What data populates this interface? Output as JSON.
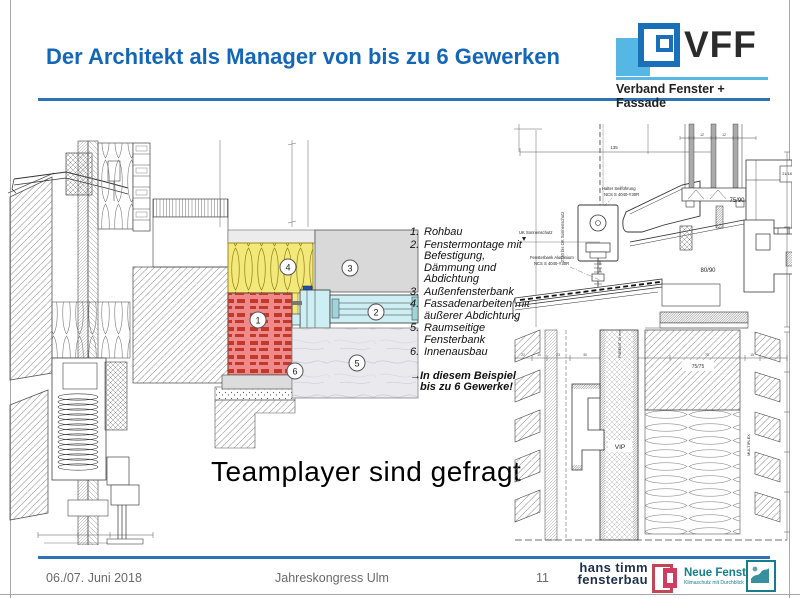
{
  "slide": {
    "title": "Der Architekt als Manager von bis zu 6 Gewerken",
    "tagline": "Teamplayer sind gefragt"
  },
  "colors": {
    "accent_blue": "#2e74b5",
    "title_blue": "#1467b8",
    "vff_lightblue": "#56b7e5",
    "insulation_yellow": "#f3e87a",
    "brick_red": "#f08a8a",
    "frame_cyan": "#cdeef2",
    "hanstimm_red": "#d13d62",
    "neuefenster_teal": "#157d8d"
  },
  "logo_vff": {
    "acronym": "VFF",
    "subtitle": "Verband Fenster + Fassade"
  },
  "gewerke_list": {
    "items": [
      {
        "num": "1.",
        "text": "Rohbau"
      },
      {
        "num": "2.",
        "text": "Fenstermontage mit Befestigung, Dämmung und Abdichtung"
      },
      {
        "num": "3.",
        "text": "Außenfensterbank"
      },
      {
        "num": "4.",
        "text": "Fassadenarbeiten mit äußerer Abdichtung"
      },
      {
        "num": "5.",
        "text": "Raumseitige Fensterbank"
      },
      {
        "num": "6.",
        "text": "Innenausbau"
      }
    ],
    "arrow": "→",
    "conclusion_line1": "In diesem Beispiel",
    "conclusion_line2": "bis zu 6 Gewerke!"
  },
  "left_drawing": {
    "callouts": [
      "1",
      "2",
      "3",
      "4",
      "5",
      "6"
    ]
  },
  "right_drawing": {
    "labels": {
      "halter1": "Halter Seilführung",
      "halter2": "NCS S 4040-Y30R",
      "uk": "UK Sonnenschutz",
      "fb1": "Fensterbank Aluminium",
      "fb2": "NCS S 4040-Y30R",
      "vdim": "2730 bis OK Sonnenschutz",
      "d135": "135",
      "d12a": "12",
      "d12b": "12",
      "d2118": "21/18",
      "d7590": "75/90",
      "d8090": "80/90",
      "d7575": "75/75",
      "vip": "VIP",
      "purenit": "PURENIT 30 mm",
      "multiplex": "MULTIPLEX"
    },
    "dims_row": [
      "22",
      "15",
      "23",
      "30",
      "35",
      "75",
      "15"
    ]
  },
  "footer": {
    "date": "06./07. Juni 2018",
    "event": "Jahreskongress Ulm",
    "page": "11",
    "hanstimm_line1": "hans timm",
    "hanstimm_line2": "fensterbau",
    "neuefenster": "Neue Fenster",
    "neuefenster_sub": "Klimaschutz mit Durchblick"
  }
}
